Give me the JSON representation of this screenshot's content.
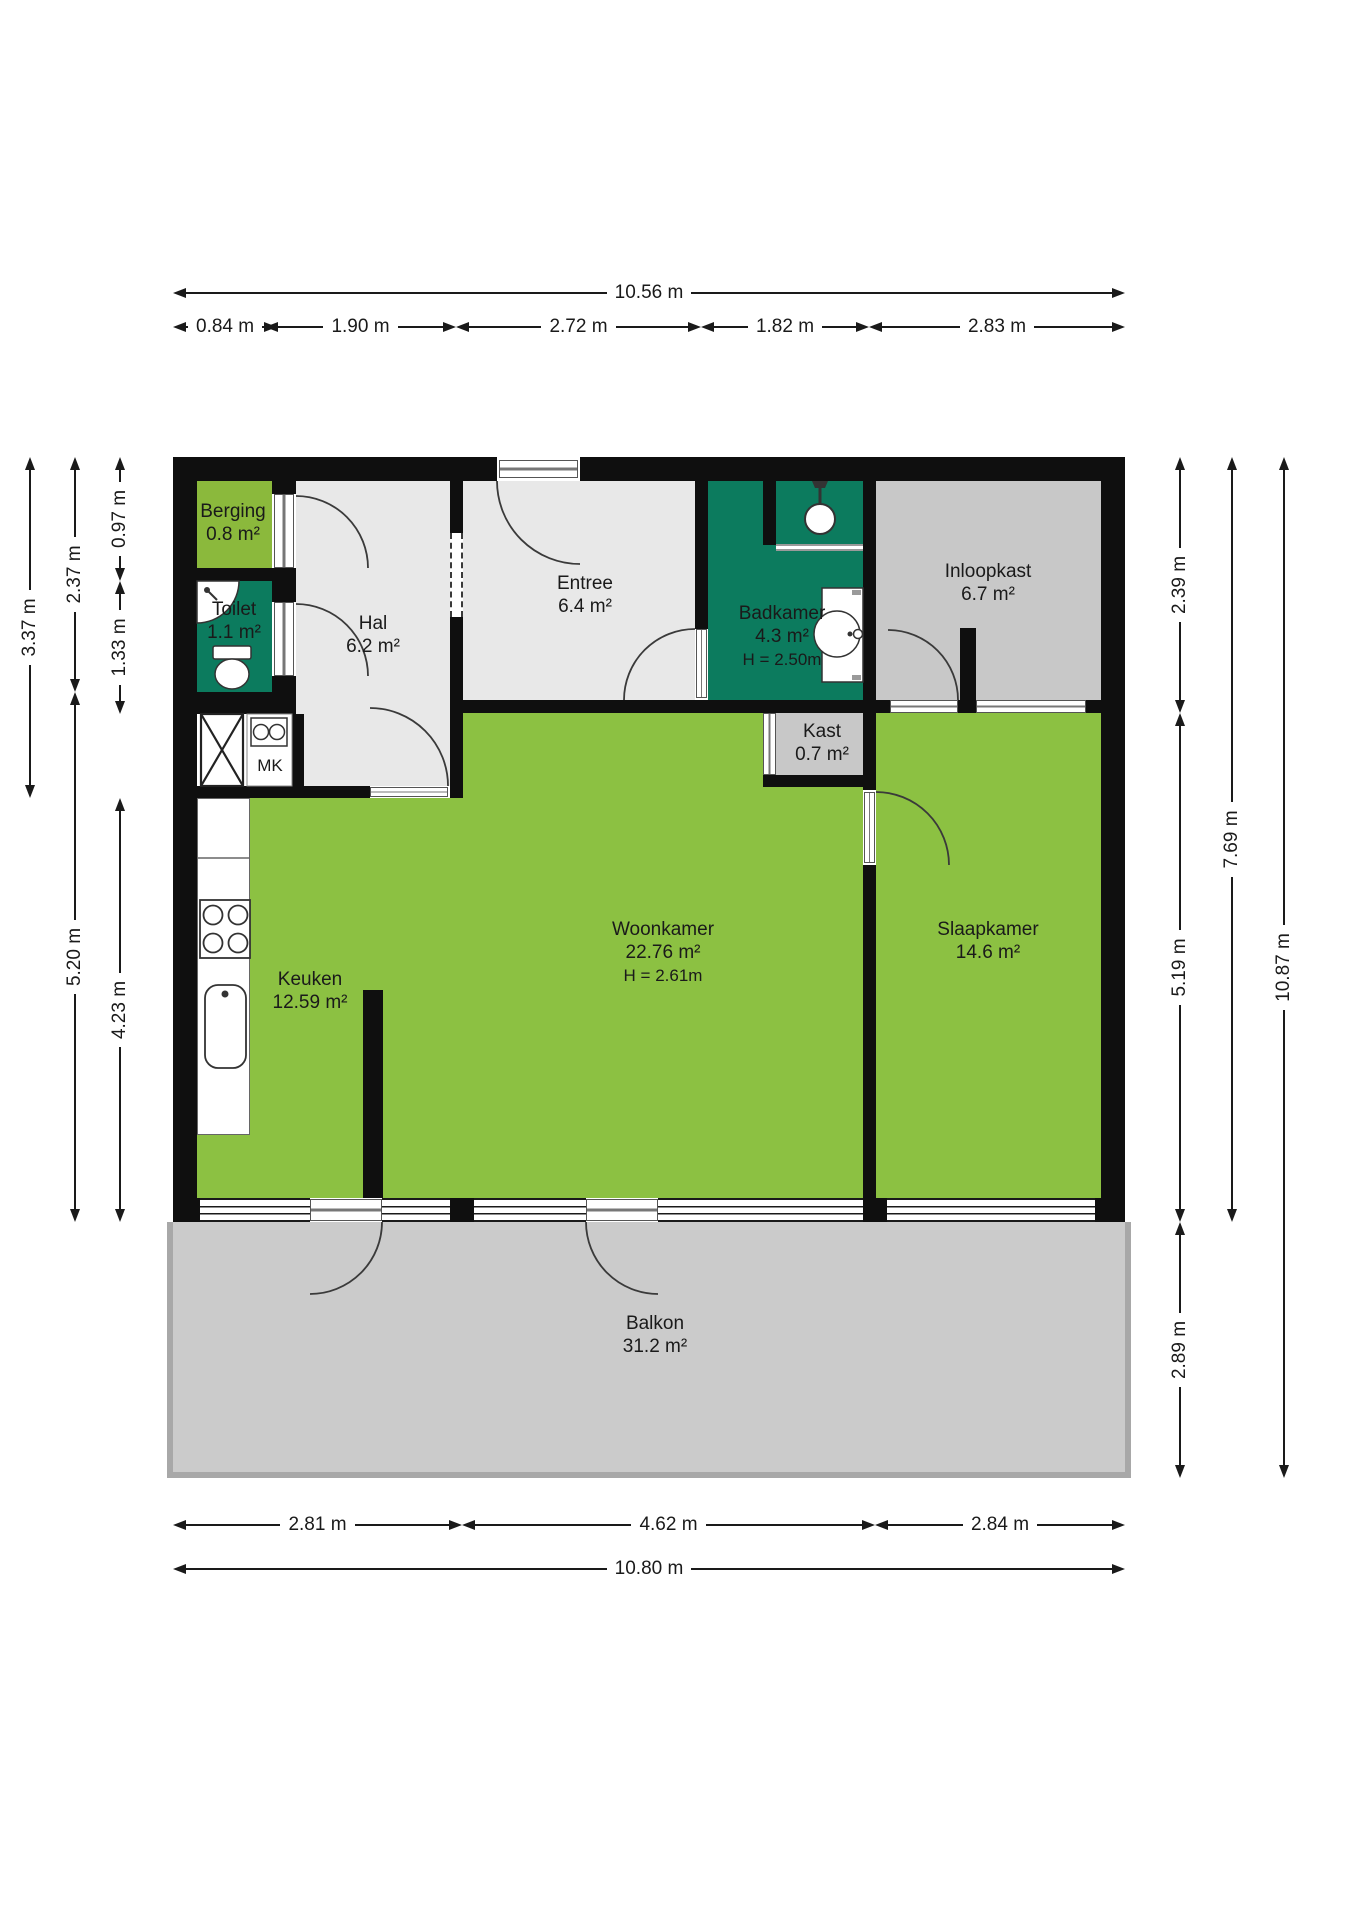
{
  "rooms": {
    "berging": {
      "name": "Berging",
      "area": "0.8 m²"
    },
    "toilet": {
      "name": "Toilet",
      "area": "1.1 m²"
    },
    "hal": {
      "name": "Hal",
      "area": "6.2 m²"
    },
    "entree": {
      "name": "Entree",
      "area": "6.4 m²"
    },
    "badkamer": {
      "name": "Badkamer",
      "area": "4.3 m²",
      "ceiling": "H = 2.50m"
    },
    "inloopkast": {
      "name": "Inloopkast",
      "area": "6.7 m²"
    },
    "kast": {
      "name": "Kast",
      "area": "0.7 m²"
    },
    "keuken": {
      "name": "Keuken",
      "area": "12.59 m²"
    },
    "woonkamer": {
      "name": "Woonkamer",
      "area": "22.76 m²",
      "ceiling": "H = 2.61m"
    },
    "slaapkamer": {
      "name": "Slaapkamer",
      "area": "14.6 m²"
    },
    "balkon": {
      "name": "Balkon",
      "area": "31.2 m²"
    },
    "meterkast": {
      "label": "MK"
    }
  },
  "dims": {
    "top_total": "10.56 m",
    "top_segments": [
      "0.84 m",
      "1.90 m",
      "2.72 m",
      "1.82 m",
      "2.83 m"
    ],
    "bottom_segments": [
      "2.81 m",
      "4.62 m",
      "2.84 m"
    ],
    "bottom_total": "10.80 m",
    "left_outer": "3.37 m",
    "left_mid": [
      "2.37 m",
      "5.20 m"
    ],
    "left_inner": [
      "0.97 m",
      "1.33 m",
      "4.23 m"
    ],
    "right_inner": [
      "2.39 m",
      "5.19 m",
      "2.89 m"
    ],
    "right_mid": "7.69 m",
    "right_outer": "10.87 m"
  },
  "colors": {
    "wall": "#0f0f0f",
    "living_green": "#8cc142",
    "sanitary_teal": "#0c7b5e",
    "hall_light_gray": "#e8e8e8",
    "closet_gray": "#c8c8c8",
    "balkon_gray": "#cbcbcb"
  }
}
